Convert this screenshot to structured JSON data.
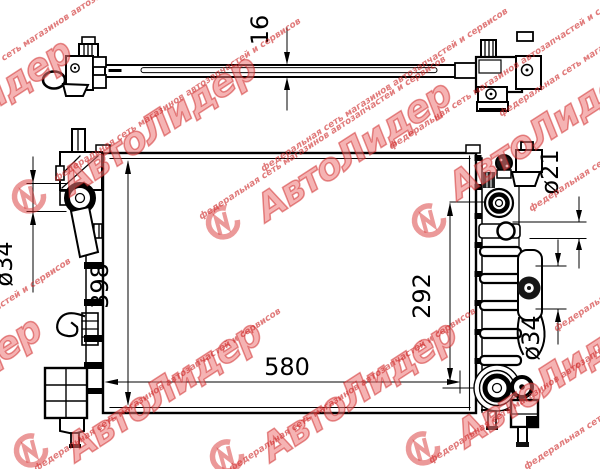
{
  "page": {
    "background": "#ffffff",
    "line_color": "#000000"
  },
  "drawing": {
    "dimensions": {
      "top_view_thickness": "16",
      "core_height": "398",
      "core_width": "580",
      "cap_to_outlet": "292",
      "inlet_diameter": "ø34",
      "filler_neck_diameter": "ø21",
      "outlet_diameter": "ø34"
    }
  },
  "watermark": {
    "brand": "АвтоЛидер",
    "tagline": "федеральная сеть магазинов автозапчастей и сервисов",
    "color": "#d83a3a"
  }
}
